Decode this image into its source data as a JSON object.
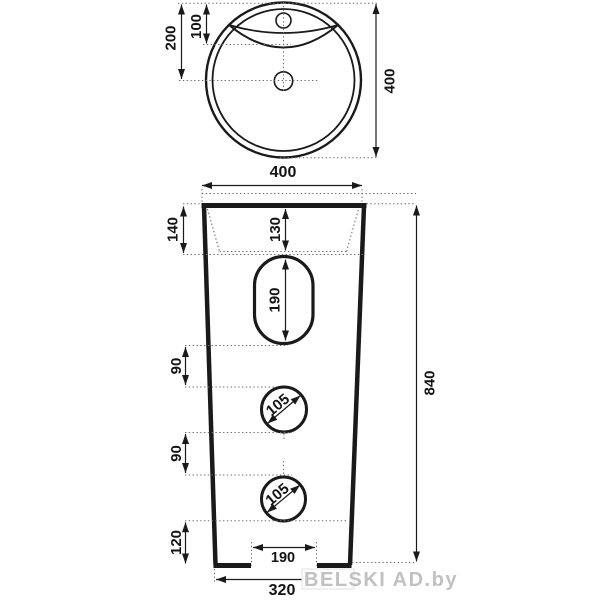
{
  "drawing_title": "pedestal-washbasin-dimension-drawing",
  "colors": {
    "outline": "#1a1a1a",
    "dimension_line": "#1a1a1a",
    "dotted_line": "#6e6e6e",
    "text": "#141414",
    "watermark": "#b7b7b7",
    "background": "#ffffff"
  },
  "top_view": {
    "diameter": "400",
    "bowl_offset": "200",
    "overflow_offset": "100"
  },
  "front_view": {
    "top_width": "400",
    "rim_height": "140",
    "basin_depth": "130",
    "slot_height": "190",
    "upper_gap": "90",
    "upper_hole": "105",
    "lower_gap": "90",
    "lower_hole": "105",
    "base_height": "120",
    "notch_width": "190",
    "bottom_width": "320",
    "total_height": "840"
  },
  "watermark": {
    "text": "BELSKI AD.by"
  }
}
